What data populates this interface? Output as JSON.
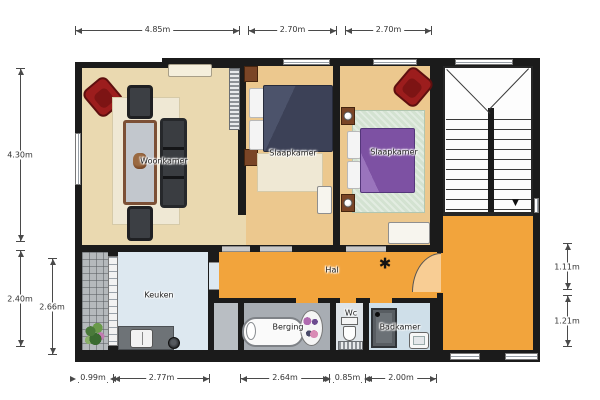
{
  "plan": {
    "rooms": {
      "woonkamer": "Woonkamer",
      "slaapkamer1": "Slaapkamer",
      "slaapkamer2": "Slaapkamer",
      "keuken": "Keuken",
      "hal": "Hal",
      "berging": "Berging",
      "wc": "Wc",
      "badkamer": "Badkamer"
    },
    "hal_symbol": "✱",
    "stairs_arrow": "▼",
    "colors": {
      "wall": "#1b1b1b",
      "hall_orange": "#f2a43c",
      "bedroom_floor": "#ecc88e",
      "living_floor": "#ead9b0",
      "kitchen_floor": "#dde8f0",
      "bath_floor": "#cfdfe9",
      "storage_floor": "#a8adb3"
    }
  },
  "dimensions": {
    "top": [
      "4.85m",
      "2.70m",
      "2.70m"
    ],
    "bottom": [
      "0.99m",
      "2.77m",
      "2.64m",
      "0.85m",
      "2.00m"
    ],
    "left": [
      "4.30m",
      "2.40m",
      "2.66m"
    ],
    "right": [
      "1.11m",
      "1.21m"
    ]
  }
}
